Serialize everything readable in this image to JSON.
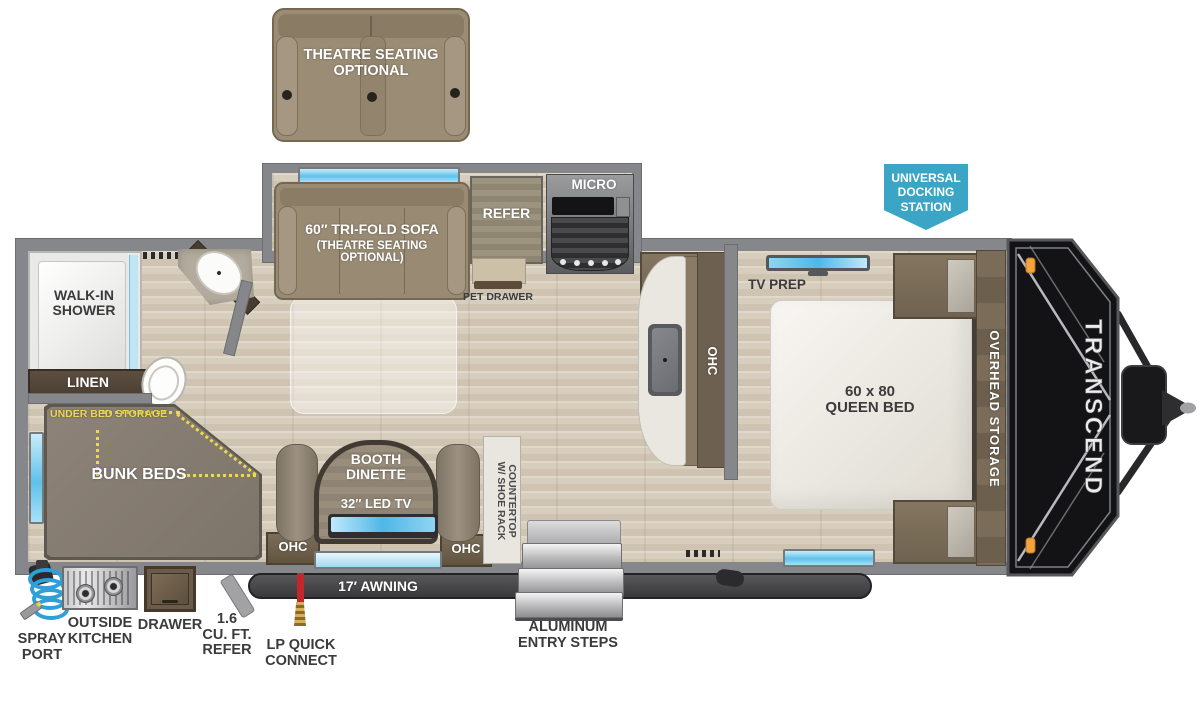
{
  "title": "Transcend travel trailer floor plan",
  "brand": {
    "front_cap": "TRANSCEND"
  },
  "badge": {
    "docking_station": "UNIVERSAL\nDOCKING\nSTATION"
  },
  "living": {
    "theatre_seating": "THEATRE SEATING\nOPTIONAL",
    "sofa_title": "60″ TRI-FOLD SOFA",
    "sofa_sub": "(THEATRE SEATING\nOPTIONAL)",
    "refer": "REFER",
    "micro": "MICRO",
    "pet_drawer": "PET DRAWER",
    "booth_dinette": "BOOTH\nDINETTE",
    "led_tv": "32″ LED TV",
    "ohc_left": "OHC",
    "ohc_right": "OHC",
    "kitchen_ohc": "OHC",
    "countertop": "COUNTERTOP\nW/ SHOE RACK"
  },
  "bath": {
    "walk_in_shower": "WALK-IN\nSHOWER",
    "linen": "LINEN",
    "ohc": "OHC"
  },
  "bunk": {
    "under_bed_storage": "UNDER BED STORAGE",
    "bunk_beds": "BUNK BEDS"
  },
  "bedroom": {
    "tv_prep": "TV PREP",
    "queen_bed": "60 x 80\nQUEEN BED",
    "overhead_storage": "OVERHEAD STORAGE"
  },
  "exterior": {
    "awning": "17′ AWNING",
    "spray_port": "SPRAY\nPORT",
    "outside_kitchen": "OUTSIDE\nKITCHEN",
    "drawer": "DRAWER",
    "mini_refer": "1.6\nCU. FT.\nREFER",
    "lp_quick_connect": "LP QUICK\nCONNECT",
    "entry_steps": "ALUMINUM\nENTRY STEPS"
  },
  "colors": {
    "badge_teal": "#3BA5C5",
    "window_blue": "#5FC1EA",
    "storage_yellow": "#ECD94E",
    "wall_gray": "#85878A",
    "awning_dark": "#3A3A3C"
  }
}
